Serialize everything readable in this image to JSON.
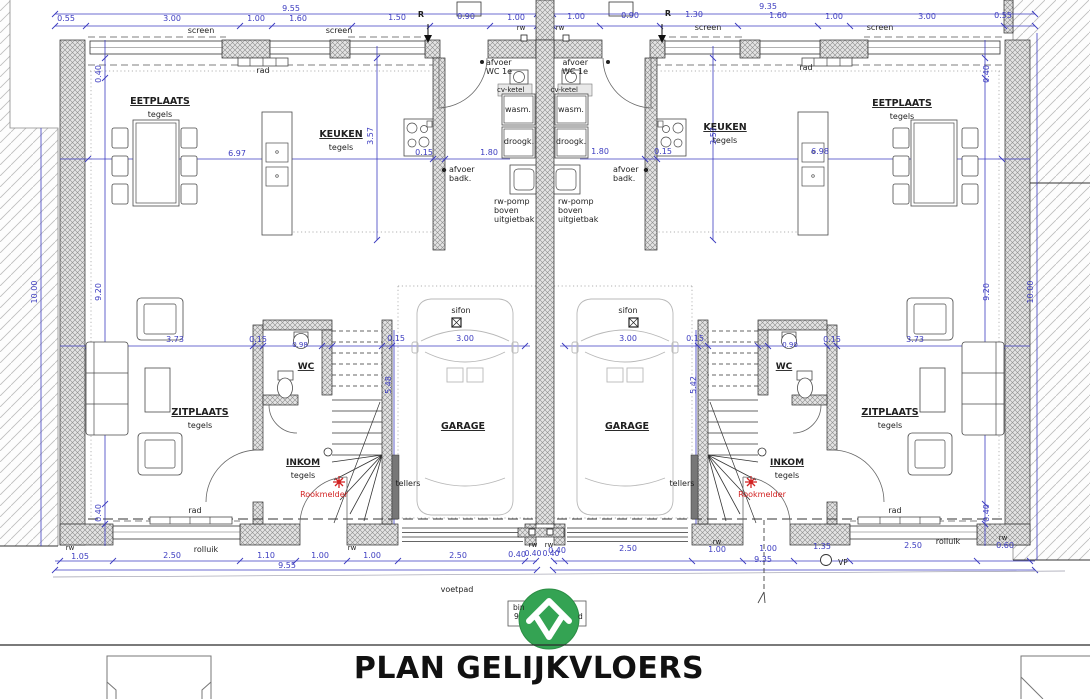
{
  "title": "PLAN GELIJKVLOERS",
  "colors": {
    "b": "#3c3cc0",
    "k": "#1f1f1f",
    "r": "#d22222",
    "g": "#666666"
  },
  "logo": {
    "name": "house-logo",
    "bg": "#34a353"
  },
  "rooms": [
    "EETPLAATS",
    "KEUKEN",
    "ZITPLAATS",
    "INKOM",
    "WC",
    "GARAGE"
  ],
  "labels": [
    {
      "n": "dim-total-left",
      "t": "9.55",
      "x": 291,
      "y": 11,
      "c": "b"
    },
    {
      "t": "0.55",
      "x": 66,
      "y": 21,
      "c": "b"
    },
    {
      "t": "3.00",
      "x": 172,
      "y": 21,
      "c": "b"
    },
    {
      "t": "1.00",
      "x": 256,
      "y": 21,
      "c": "b"
    },
    {
      "t": "1.60",
      "x": 298,
      "y": 21,
      "c": "b"
    },
    {
      "t": "1.50",
      "x": 397,
      "y": 20,
      "c": "b"
    },
    {
      "n": "r-mark-left",
      "t": "R",
      "x": 421,
      "y": 17,
      "c": "k",
      "w": 1
    },
    {
      "t": "0.90",
      "x": 466,
      "y": 19,
      "c": "b"
    },
    {
      "t": "1.00",
      "x": 516,
      "y": 20,
      "c": "b"
    },
    {
      "t": "screen",
      "x": 201,
      "y": 33,
      "c": "k"
    },
    {
      "t": "screen",
      "x": 339,
      "y": 33,
      "c": "k"
    },
    {
      "t": "rw",
      "x": 521,
      "y": 30,
      "c": "k",
      "s": 7
    },
    {
      "t": "rw",
      "x": 560,
      "y": 30,
      "c": "k",
      "s": 7
    },
    {
      "n": "dim-total-right",
      "t": "9.35",
      "x": 768,
      "y": 9,
      "c": "b"
    },
    {
      "t": "1.00",
      "x": 576,
      "y": 19,
      "c": "b"
    },
    {
      "t": "0.90",
      "x": 630,
      "y": 18,
      "c": "b"
    },
    {
      "n": "r-mark-right",
      "t": "R",
      "x": 668,
      "y": 16,
      "c": "k",
      "w": 1
    },
    {
      "t": "1.30",
      "x": 694,
      "y": 17,
      "c": "b"
    },
    {
      "t": "1.60",
      "x": 778,
      "y": 18,
      "c": "b"
    },
    {
      "t": "1.00",
      "x": 834,
      "y": 19,
      "c": "b"
    },
    {
      "t": "3.00",
      "x": 927,
      "y": 19,
      "c": "b"
    },
    {
      "t": "0.55",
      "x": 1003,
      "y": 18,
      "c": "b"
    },
    {
      "t": "screen",
      "x": 708,
      "y": 30,
      "c": "k"
    },
    {
      "t": "screen",
      "x": 880,
      "y": 30,
      "c": "k"
    },
    {
      "t": "rad",
      "x": 263,
      "y": 73,
      "c": "k"
    },
    {
      "t": "afvoer",
      "x": 486,
      "y": 65,
      "c": "k",
      "a": "s"
    },
    {
      "t": "WC 1e",
      "x": 486,
      "y": 74,
      "c": "k",
      "a": "s"
    },
    {
      "t": "cv-ketel",
      "x": 497,
      "y": 92,
      "c": "k",
      "a": "s",
      "s": 7
    },
    {
      "t": "wasm.",
      "x": 518,
      "y": 112,
      "c": "k"
    },
    {
      "t": "droogk.",
      "x": 519,
      "y": 144,
      "c": "k"
    },
    {
      "t": "afvoer",
      "x": 449,
      "y": 172,
      "c": "k",
      "a": "s"
    },
    {
      "t": "badk.",
      "x": 449,
      "y": 181,
      "c": "k",
      "a": "s"
    },
    {
      "t": "rw-pomp",
      "x": 494,
      "y": 204,
      "c": "k",
      "a": "s"
    },
    {
      "t": "boven",
      "x": 494,
      "y": 213,
      "c": "k",
      "a": "s"
    },
    {
      "t": "uitgietbak",
      "x": 494,
      "y": 222,
      "c": "k",
      "a": "s"
    },
    {
      "n": "room-eetplaats-left",
      "t": "EETPLAATS",
      "x": 160,
      "y": 104,
      "c": "k",
      "w": 1,
      "u": 1,
      "s": 9.5
    },
    {
      "t": "tegels",
      "x": 160,
      "y": 117,
      "c": "k"
    },
    {
      "n": "room-keuken-left",
      "t": "KEUKEN",
      "x": 341,
      "y": 137,
      "c": "k",
      "w": 1,
      "u": 1,
      "s": 9.5
    },
    {
      "t": "tegels",
      "x": 341,
      "y": 150,
      "c": "k"
    },
    {
      "t": "6.97",
      "x": 237,
      "y": 156,
      "c": "b"
    },
    {
      "t": "0.15",
      "x": 424,
      "y": 155,
      "c": "b"
    },
    {
      "t": "1.80",
      "x": 489,
      "y": 155,
      "c": "b"
    },
    {
      "t": "3.57",
      "x": 373,
      "y": 136,
      "c": "b",
      "r": 1
    },
    {
      "t": "0.40",
      "x": 101,
      "y": 74,
      "c": "b",
      "r": 1
    },
    {
      "t": "9.20",
      "x": 101,
      "y": 292,
      "c": "b",
      "r": 1
    },
    {
      "t": "0.40",
      "x": 101,
      "y": 513,
      "c": "b",
      "r": 1
    },
    {
      "t": "10.00",
      "x": 37,
      "y": 292,
      "c": "b",
      "r": 1
    },
    {
      "t": "sifon",
      "x": 461,
      "y": 313,
      "c": "k"
    },
    {
      "t": "0.15",
      "x": 396,
      "y": 341,
      "c": "b"
    },
    {
      "t": "3.00",
      "x": 465,
      "y": 341,
      "c": "b"
    },
    {
      "t": "5.48",
      "x": 391,
      "y": 385,
      "c": "b",
      "r": 1
    },
    {
      "n": "room-garage-left",
      "t": "GARAGE",
      "x": 463,
      "y": 429,
      "c": "k",
      "w": 1,
      "u": 1,
      "s": 9.5
    },
    {
      "t": "tellers",
      "x": 408,
      "y": 486,
      "c": "k"
    },
    {
      "n": "room-wc-left",
      "t": "WC",
      "x": 306,
      "y": 369,
      "c": "k",
      "w": 1,
      "u": 1,
      "s": 9
    },
    {
      "t": "0.98",
      "x": 300,
      "y": 347,
      "c": "b",
      "s": 7
    },
    {
      "t": "0.15",
      "x": 258,
      "y": 342,
      "c": "b"
    },
    {
      "t": "3.73",
      "x": 175,
      "y": 342,
      "c": "b"
    },
    {
      "n": "room-zitplaats-left",
      "t": "ZITPLAATS",
      "x": 200,
      "y": 415,
      "c": "k",
      "w": 1,
      "u": 1,
      "s": 9.5
    },
    {
      "t": "tegels",
      "x": 200,
      "y": 428,
      "c": "k"
    },
    {
      "n": "room-inkom-left",
      "t": "INKOM",
      "x": 303,
      "y": 465,
      "c": "k",
      "w": 1,
      "u": 1,
      "s": 9
    },
    {
      "t": "tegels",
      "x": 303,
      "y": 478,
      "c": "k"
    },
    {
      "n": "rookmelder-left",
      "t": "Rookmelder",
      "x": 324,
      "y": 497,
      "c": "r"
    },
    {
      "t": "rad",
      "x": 195,
      "y": 513,
      "c": "k"
    },
    {
      "t": "rw",
      "x": 70,
      "y": 550,
      "c": "k",
      "s": 7
    },
    {
      "t": "1.05",
      "x": 80,
      "y": 559,
      "c": "b"
    },
    {
      "t": "2.50",
      "x": 172,
      "y": 558,
      "c": "b"
    },
    {
      "t": "rolluik",
      "x": 206,
      "y": 552,
      "c": "k"
    },
    {
      "t": "1.10",
      "x": 266,
      "y": 558,
      "c": "b"
    },
    {
      "t": "1.00",
      "x": 320,
      "y": 558,
      "c": "b"
    },
    {
      "t": "rw",
      "x": 352,
      "y": 550,
      "c": "k",
      "s": 7
    },
    {
      "t": "1.00",
      "x": 372,
      "y": 558,
      "c": "b"
    },
    {
      "t": "2.50",
      "x": 458,
      "y": 558,
      "c": "b"
    },
    {
      "t": "0.40",
      "x": 517,
      "y": 557,
      "c": "b"
    },
    {
      "t": "rw",
      "x": 533,
      "y": 547,
      "c": "k",
      "s": 7
    },
    {
      "t": "rw",
      "x": 549,
      "y": 547,
      "c": "k",
      "s": 7
    },
    {
      "t": "0.40",
      "x": 533,
      "y": 556,
      "c": "b",
      "s": 7.5
    },
    {
      "t": "0.40",
      "x": 551,
      "y": 556,
      "c": "b",
      "s": 7.5
    },
    {
      "n": "dim-bottom-total-left",
      "t": "9.55",
      "x": 287,
      "y": 568,
      "c": "b"
    },
    {
      "t": "rad",
      "x": 806,
      "y": 70,
      "c": "k"
    },
    {
      "t": "afvoer",
      "x": 588,
      "y": 65,
      "c": "k",
      "a": "e"
    },
    {
      "t": "WC 1e",
      "x": 588,
      "y": 74,
      "c": "k",
      "a": "e"
    },
    {
      "t": "cv-ketel",
      "x": 578,
      "y": 92,
      "c": "k",
      "a": "e",
      "s": 7
    },
    {
      "t": "wasm.",
      "x": 571,
      "y": 112,
      "c": "k"
    },
    {
      "t": "droogk.",
      "x": 571,
      "y": 144,
      "c": "k"
    },
    {
      "t": "afvoer",
      "x": 613,
      "y": 172,
      "c": "k",
      "a": "s"
    },
    {
      "t": "badk.",
      "x": 613,
      "y": 181,
      "c": "k",
      "a": "s"
    },
    {
      "t": "rw-pomp",
      "x": 558,
      "y": 204,
      "c": "k",
      "a": "s"
    },
    {
      "t": "boven",
      "x": 558,
      "y": 213,
      "c": "k",
      "a": "s"
    },
    {
      "t": "uitgietbak",
      "x": 558,
      "y": 222,
      "c": "k",
      "a": "s"
    },
    {
      "n": "room-keuken-right",
      "t": "KEUKEN",
      "x": 725,
      "y": 130,
      "c": "k",
      "w": 1,
      "u": 1,
      "s": 9.5
    },
    {
      "t": "tegels",
      "x": 725,
      "y": 143,
      "c": "k"
    },
    {
      "n": "room-eetplaats-right",
      "t": "EETPLAATS",
      "x": 902,
      "y": 106,
      "c": "k",
      "w": 1,
      "u": 1,
      "s": 9.5
    },
    {
      "t": "tegels",
      "x": 902,
      "y": 119,
      "c": "k"
    },
    {
      "t": "1.80",
      "x": 600,
      "y": 154,
      "c": "b"
    },
    {
      "t": "0.15",
      "x": 663,
      "y": 154,
      "c": "b"
    },
    {
      "t": "6.98",
      "x": 820,
      "y": 154,
      "c": "b"
    },
    {
      "t": "3.57",
      "x": 716,
      "y": 136,
      "c": "b",
      "r": 1
    },
    {
      "t": "0.40",
      "x": 989,
      "y": 74,
      "c": "b",
      "r": 1
    },
    {
      "t": "9.20",
      "x": 989,
      "y": 292,
      "c": "b",
      "r": 1
    },
    {
      "t": "0.40",
      "x": 989,
      "y": 513,
      "c": "b",
      "r": 1
    },
    {
      "t": "10.00",
      "x": 1033,
      "y": 292,
      "c": "b",
      "r": 1
    },
    {
      "t": "sifon",
      "x": 628,
      "y": 313,
      "c": "k"
    },
    {
      "t": "3.00",
      "x": 628,
      "y": 341,
      "c": "b"
    },
    {
      "t": "0.15",
      "x": 695,
      "y": 341,
      "c": "b"
    },
    {
      "t": "5.42",
      "x": 696,
      "y": 385,
      "c": "b",
      "r": 1
    },
    {
      "n": "room-garage-right",
      "t": "GARAGE",
      "x": 627,
      "y": 429,
      "c": "k",
      "w": 1,
      "u": 1,
      "s": 9.5
    },
    {
      "t": "tellers",
      "x": 682,
      "y": 486,
      "c": "k"
    },
    {
      "n": "room-wc-right",
      "t": "WC",
      "x": 784,
      "y": 369,
      "c": "k",
      "w": 1,
      "u": 1,
      "s": 9
    },
    {
      "t": "0.90",
      "x": 790,
      "y": 347,
      "c": "b",
      "s": 7
    },
    {
      "t": "0.15",
      "x": 832,
      "y": 342,
      "c": "b"
    },
    {
      "t": "3.73",
      "x": 915,
      "y": 342,
      "c": "b"
    },
    {
      "n": "room-zitplaats-right",
      "t": "ZITPLAATS",
      "x": 890,
      "y": 415,
      "c": "k",
      "w": 1,
      "u": 1,
      "s": 9.5
    },
    {
      "t": "tegels",
      "x": 890,
      "y": 428,
      "c": "k"
    },
    {
      "n": "room-inkom-right",
      "t": "INKOM",
      "x": 787,
      "y": 465,
      "c": "k",
      "w": 1,
      "u": 1,
      "s": 9
    },
    {
      "t": "tegels",
      "x": 787,
      "y": 478,
      "c": "k"
    },
    {
      "n": "rookmelder-right",
      "t": "Rookmelder",
      "x": 762,
      "y": 497,
      "c": "r"
    },
    {
      "t": "rad",
      "x": 895,
      "y": 513,
      "c": "k"
    },
    {
      "t": "0.40",
      "x": 557,
      "y": 553,
      "c": "b"
    },
    {
      "t": "2.50",
      "x": 628,
      "y": 551,
      "c": "b"
    },
    {
      "t": "rw",
      "x": 717,
      "y": 544,
      "c": "k",
      "s": 7
    },
    {
      "t": "1.00",
      "x": 717,
      "y": 552,
      "c": "b"
    },
    {
      "t": "1.00",
      "x": 768,
      "y": 551,
      "c": "b"
    },
    {
      "t": "1.35",
      "x": 822,
      "y": 549,
      "c": "b"
    },
    {
      "t": "2.50",
      "x": 913,
      "y": 548,
      "c": "b"
    },
    {
      "t": "rolluik",
      "x": 948,
      "y": 544,
      "c": "k"
    },
    {
      "t": "rw",
      "x": 1003,
      "y": 540,
      "c": "k",
      "s": 7
    },
    {
      "t": "0.60",
      "x": 1005,
      "y": 548,
      "c": "b"
    },
    {
      "n": "dim-bottom-total-right",
      "t": "9.35",
      "x": 763,
      "y": 562,
      "c": "b"
    },
    {
      "n": "vp-mark",
      "t": "VP",
      "x": 843,
      "y": 565,
      "c": "k",
      "s": 7.5
    },
    {
      "n": "voetpad-label",
      "t": "voetpad",
      "x": 457,
      "y": 592,
      "c": "k"
    },
    {
      "t": "bin",
      "x": 513,
      "y": 610,
      "c": "k",
      "a": "s",
      "s": 7.5
    },
    {
      "t": "9",
      "x": 514,
      "y": 619,
      "c": "k",
      "a": "s",
      "s": 7.5
    },
    {
      "t": "d",
      "x": 578,
      "y": 619,
      "c": "k",
      "a": "s",
      "s": 7.5
    }
  ]
}
